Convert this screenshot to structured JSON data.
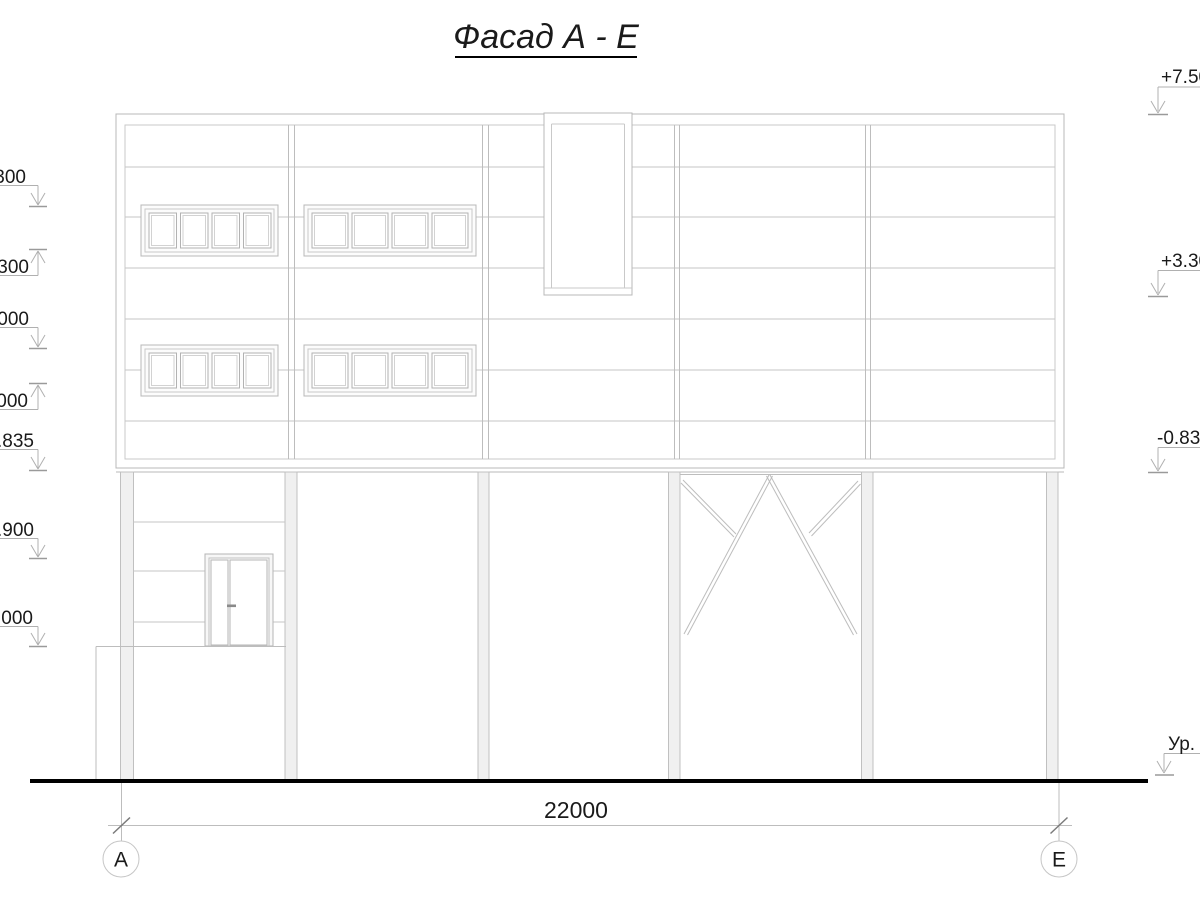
{
  "title": "Фасад А - Е",
  "drawing": {
    "type": "building-facade-elevation",
    "colors": {
      "line": "#b8b8b8",
      "light_line": "#c9c9c9",
      "text": "#1a1a1a",
      "ground": "#000000",
      "fill": "#efefef"
    }
  },
  "left_elevation_marks": [
    {
      "label": "300",
      "direction": "down"
    },
    {
      "label": "300",
      "direction": "up"
    },
    {
      "label": "000",
      "direction": "down"
    },
    {
      "label": "000",
      "direction": "up"
    },
    {
      "label": ".835",
      "direction": "down"
    },
    {
      "label": ".900",
      "direction": "down"
    },
    {
      "label": ".000",
      "direction": "down"
    }
  ],
  "right_elevation_marks": [
    {
      "label": "+7.50",
      "direction": "down"
    },
    {
      "label": "+3.30",
      "direction": "down"
    },
    {
      "label": "-0.83",
      "direction": "down"
    },
    {
      "label": "Ур.",
      "direction": "down"
    }
  ],
  "dimension": {
    "value": "22000"
  },
  "axes": [
    {
      "label": "А"
    },
    {
      "label": "Е"
    }
  ]
}
